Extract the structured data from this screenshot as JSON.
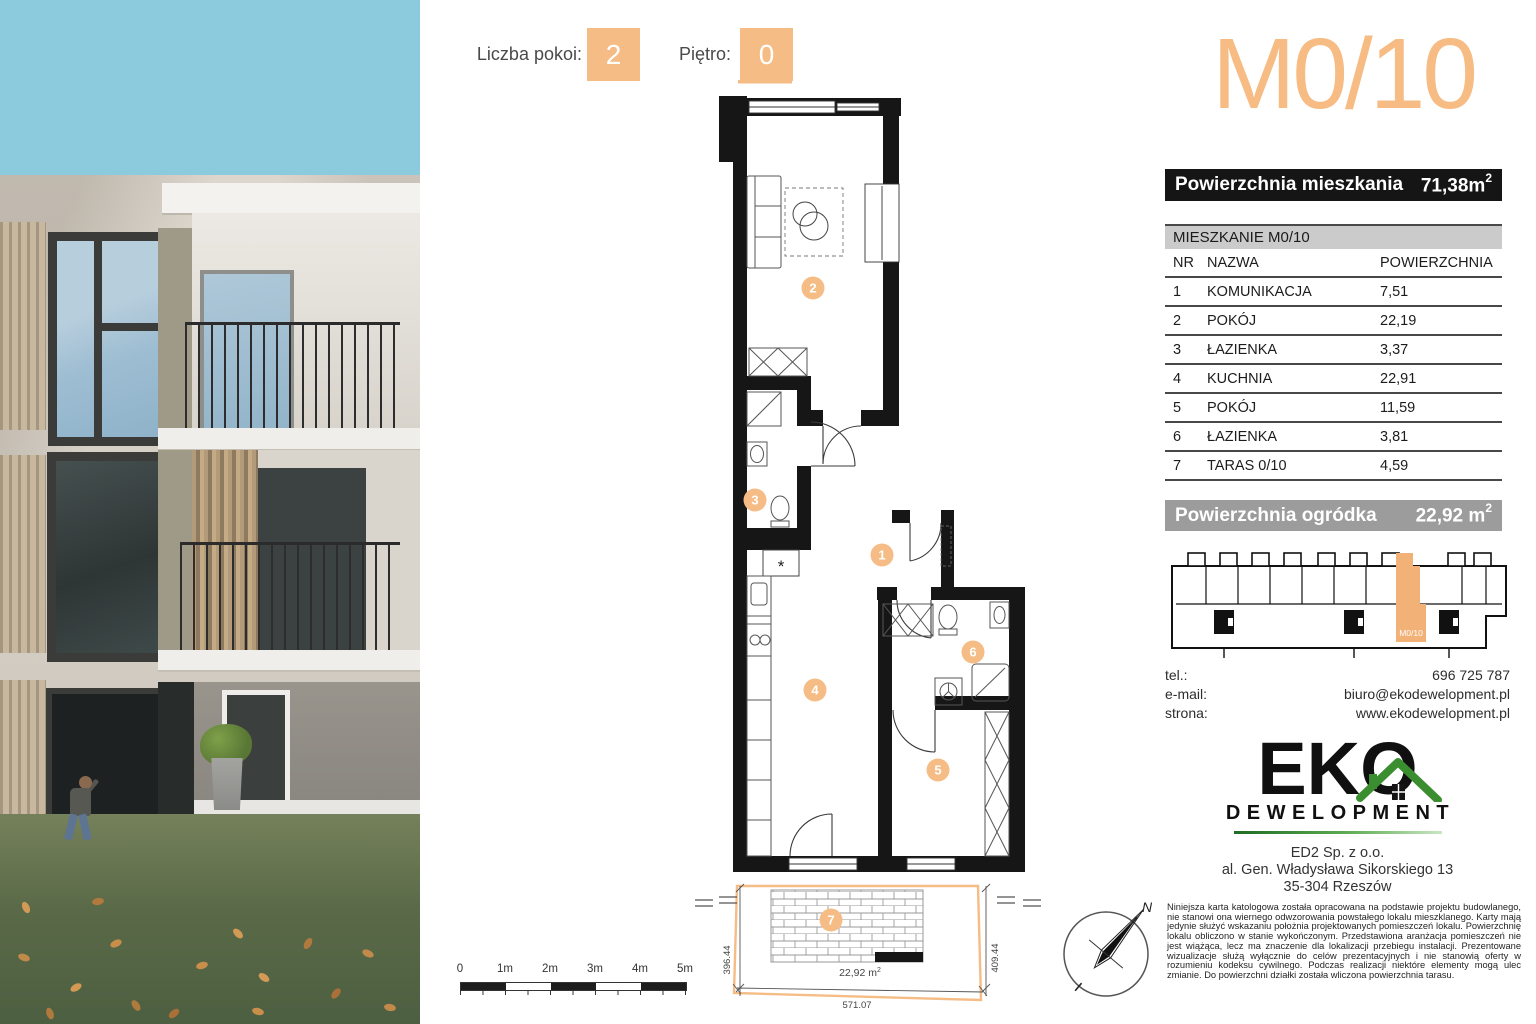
{
  "header": {
    "rooms_label": "Liczba pokoi:",
    "rooms_value": "2",
    "floor_label": "Piętro:",
    "floor_value": "0"
  },
  "unit": {
    "code": "M0/10",
    "area_label": "Powierzchnia mieszkania",
    "area_value": "71,38m",
    "area_exp": "2"
  },
  "rooms_table": {
    "title": "MIESZKANIE M0/10",
    "col_nr": "NR",
    "col_name": "NAZWA",
    "col_area": "POWIERZCHNIA",
    "rows": [
      {
        "nr": "1",
        "name": "KOMUNIKACJA",
        "area": "7,51"
      },
      {
        "nr": "2",
        "name": "POKÓJ",
        "area": "22,19"
      },
      {
        "nr": "3",
        "name": "ŁAZIENKA",
        "area": "3,37"
      },
      {
        "nr": "4",
        "name": "KUCHNIA",
        "area": "22,91"
      },
      {
        "nr": "5",
        "name": "POKÓJ",
        "area": "11,59"
      },
      {
        "nr": "6",
        "name": "ŁAZIENKA",
        "area": "3,81"
      },
      {
        "nr": "7",
        "name": "TARAS 0/10",
        "area": "4,59"
      }
    ]
  },
  "garden": {
    "label": "Powierzchnia ogródka",
    "value": "22,92 m",
    "exp": "2"
  },
  "site_plan": {
    "unit_label": "M0/10"
  },
  "contact": {
    "tel_label": "tel.:",
    "tel_value": "696 725 787",
    "email_label": "e-mail:",
    "email_value": "biuro@ekodewelopment.pl",
    "web_label": "strona:",
    "web_value": "www.ekodewelopment.pl"
  },
  "logo": {
    "name": "EKO",
    "subtitle": "DEWELOPMENT"
  },
  "address": {
    "line1": "ED2 Sp. z o.o.",
    "line2": "al. Gen. Władysława Sikorskiego 13",
    "line3": "35-304 Rzeszów"
  },
  "disclaimer": "Niniejsza karta katologowa została opracowana na podstawie projektu budowlanego, nie stanowi ona wiernego odwzorowania powstałego lokalu mieszklanego. Karty mają jedynie służyć wskazaniu położnia projektowanych pomieszczeń lokalu. Powierzchnię lokalu obliczono w stanie wykończonym. Przedstawiona aranżacja pomieszczeń nie jest wiążąca, lecz ma znaczenie dla lokalizacji przebiegu instalacji. Prezentowane wizualizacje służą wyłącznie do celów prezentacyjnych i nie stanowią oferty w rozumieniu kodeksu cywilnego. Podczas realizacji niektóre elementy mogą ulec zmianie. Do powierzchni działki została wliczona powierzchnia tarasu.",
  "plan": {
    "numbers": {
      "n1": "1",
      "n2": "2",
      "n3": "3",
      "n4": "4",
      "n5": "5",
      "n6": "6",
      "n7": "7"
    },
    "dim_left": "396.44",
    "dim_right": "409.44",
    "dim_bottom": "571.07",
    "terrace_area": "22,92 m",
    "terrace_exp": "2",
    "north": "N",
    "asterisk": "*",
    "scale": {
      "s0": "0",
      "s1": "1m",
      "s2": "2m",
      "s3": "3m",
      "s4": "4m",
      "s5": "5m"
    }
  },
  "colors": {
    "accent": "#F5BD85",
    "bar_black": "#151515",
    "bar_grey": "#9C9C9C",
    "table_header_bg": "#CBCBCB",
    "logo_green": "#3A8E2F"
  }
}
